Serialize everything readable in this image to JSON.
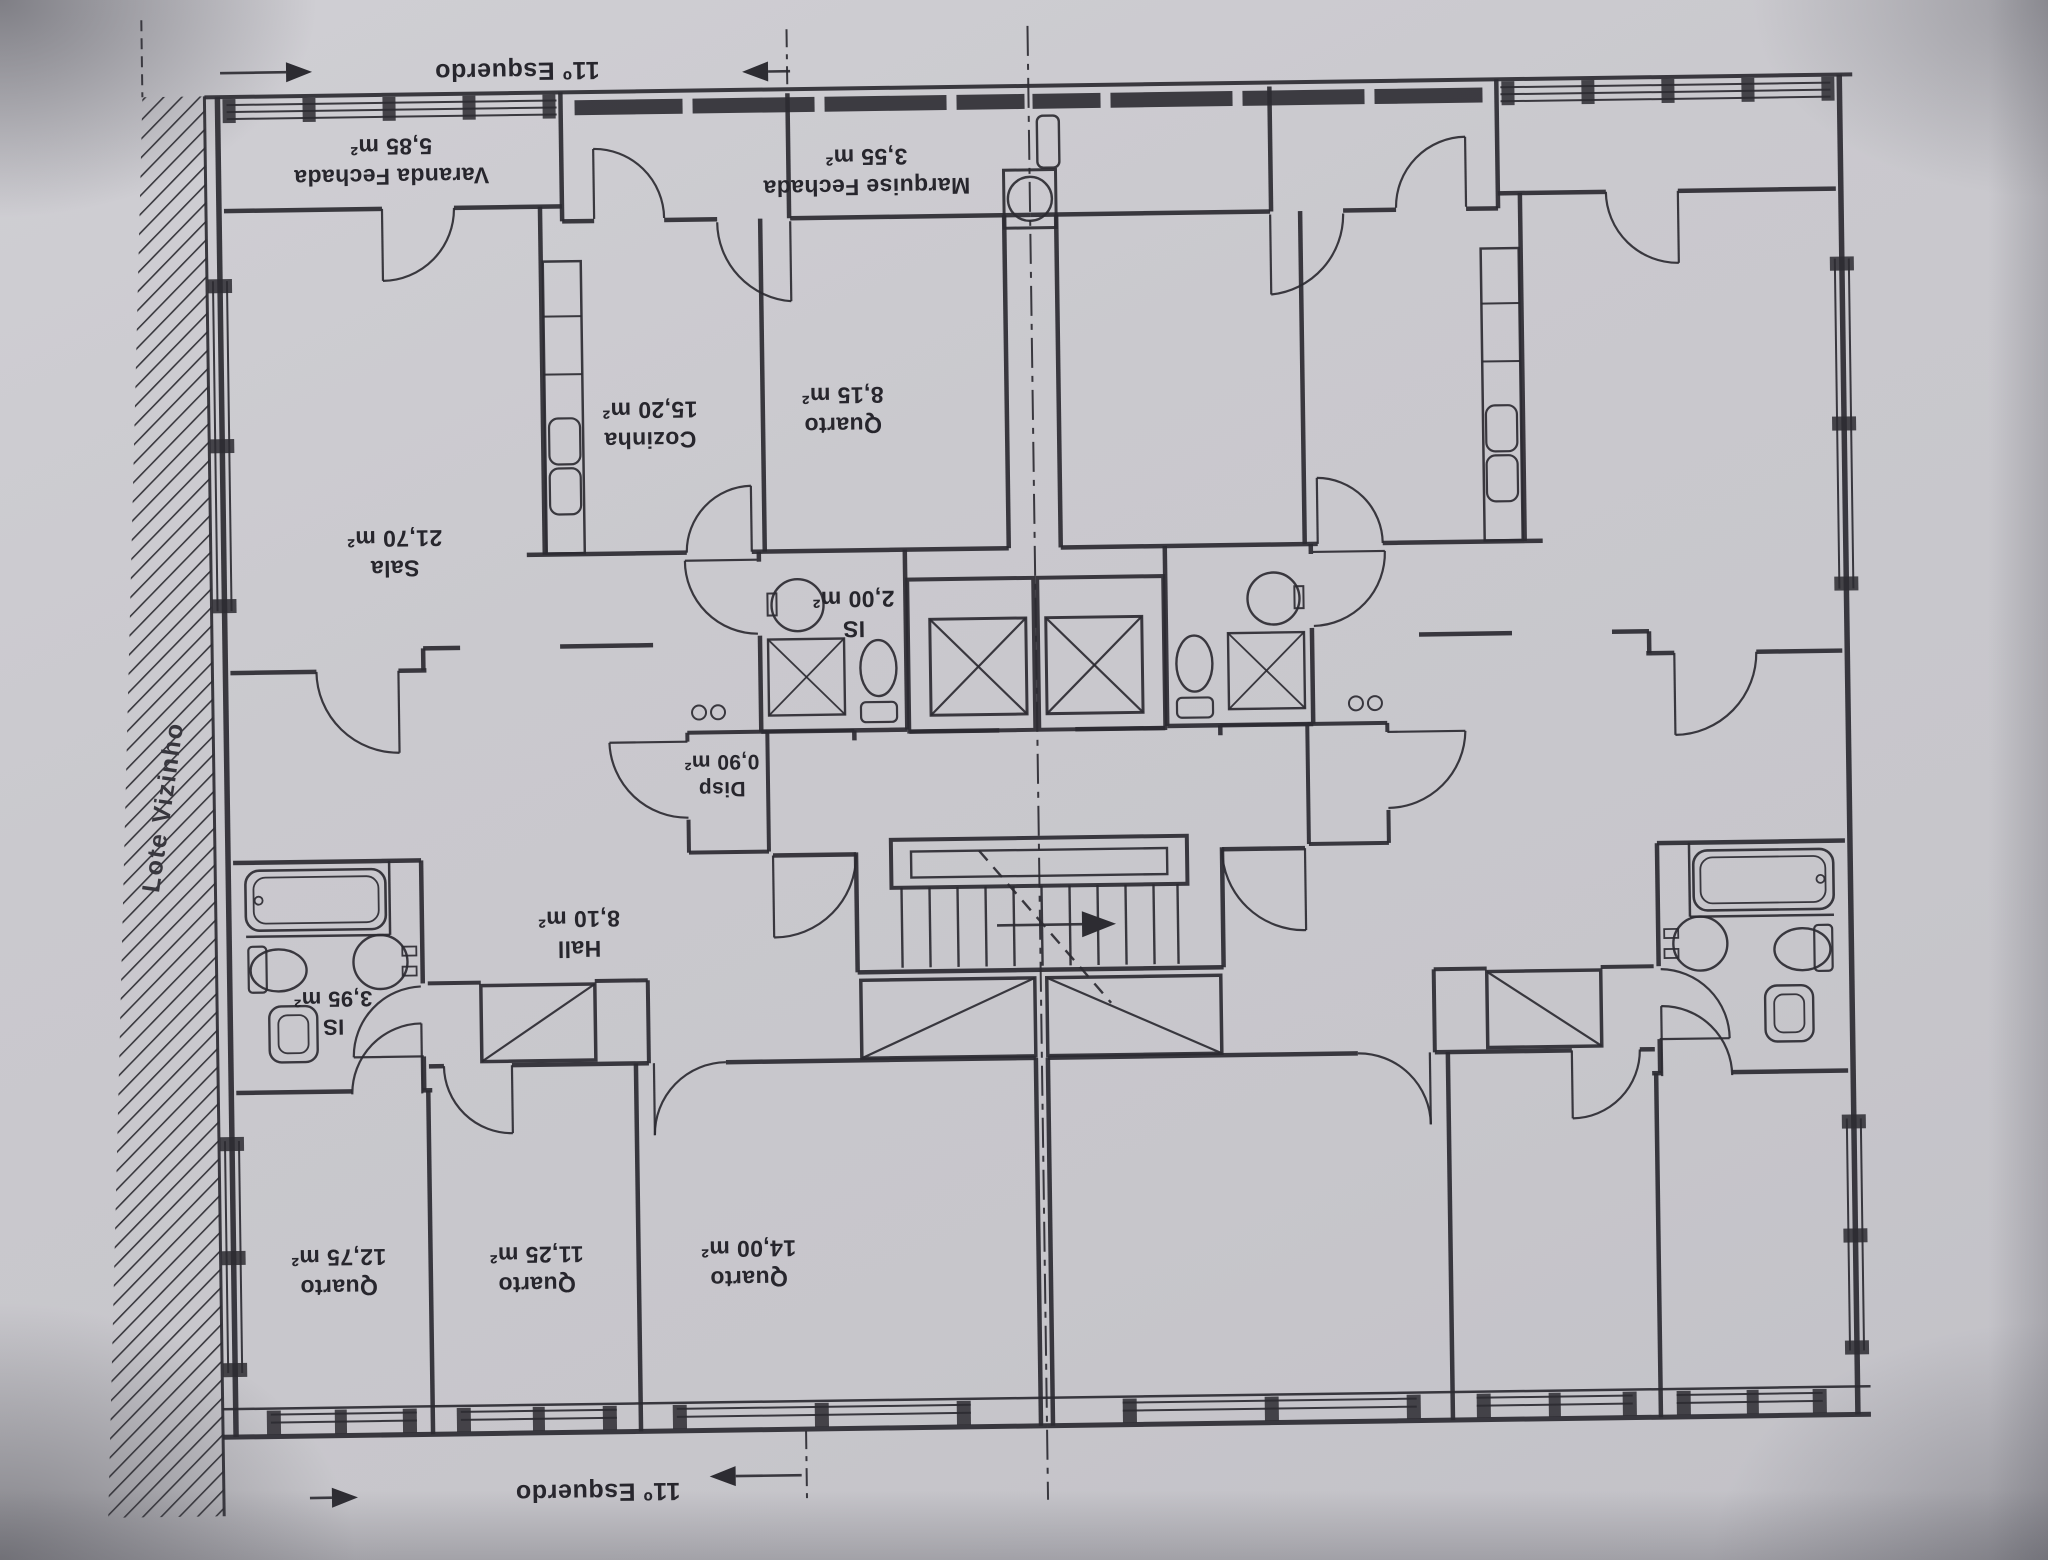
{
  "annotations": {
    "unit_top": "11º Esquerdo",
    "unit_bottom": "11º Esquerdo",
    "neighbor_lot": "Lote Vizinho"
  },
  "rooms": {
    "varanda": {
      "name": "Varanda Fechada",
      "area": "5,85 m²"
    },
    "marquise": {
      "name": "Marquise Fechada",
      "area": "3,55 m²"
    },
    "cozinha": {
      "name": "Cozinha",
      "area": "15,20 m²"
    },
    "quarto_pequeno": {
      "name": "Quarto",
      "area": "8,15 m²"
    },
    "sala": {
      "name": "Sala",
      "area": "21,70 m²"
    },
    "is_servico": {
      "name": "IS",
      "area": "2,00 m²"
    },
    "disp": {
      "name": "Disp",
      "area": "0,90 m²"
    },
    "hall": {
      "name": "Hall",
      "area": "8,10 m²"
    },
    "is_principal": {
      "name": "IS",
      "area": "3,95 m²"
    },
    "quarto_1": {
      "name": "Quarto",
      "area": "12,75 m²"
    },
    "quarto_2": {
      "name": "Quarto",
      "area": "11,25 m²"
    },
    "quarto_3": {
      "name": "Quarto",
      "area": "14,00 m²"
    }
  },
  "colors": {
    "paper": "#cac9ce",
    "ink": "#2f2e34"
  }
}
